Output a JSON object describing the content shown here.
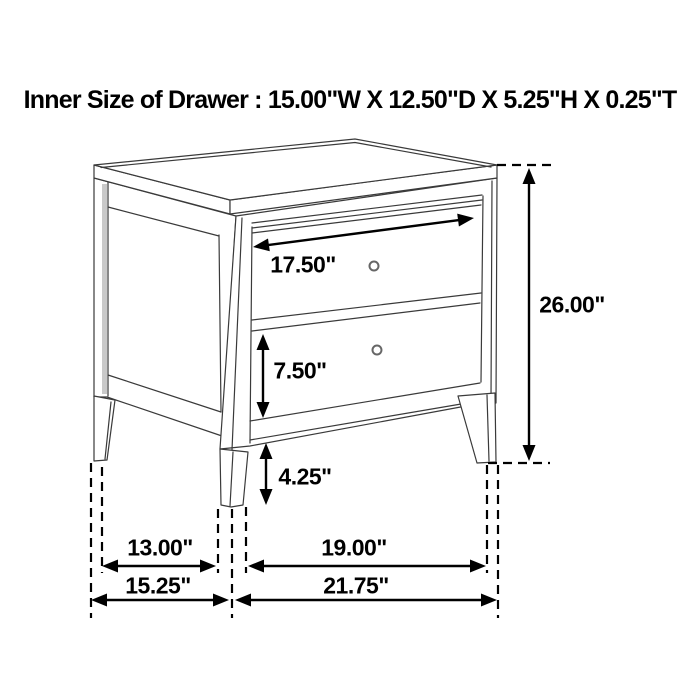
{
  "title": "Inner Size of Drawer : 15.00\"W X 12.50\"D X 5.25\"H X 0.25\"T",
  "diagram": {
    "subject": "two-drawer nightstand dimension line drawing",
    "line_color": "#3a3a3a",
    "dimension_color": "#000000",
    "dimensions": {
      "drawer_front_width": {
        "label": "17.50\""
      },
      "overall_height": {
        "label": "26.00\""
      },
      "drawer_front_height": {
        "label": "7.50\""
      },
      "leg_height": {
        "label": "4.25\""
      },
      "inner_depth": {
        "label": "13.00\""
      },
      "inner_width": {
        "label": "19.00\""
      },
      "overall_depth": {
        "label": "15.25\""
      },
      "overall_width": {
        "label": "21.75\""
      }
    }
  }
}
